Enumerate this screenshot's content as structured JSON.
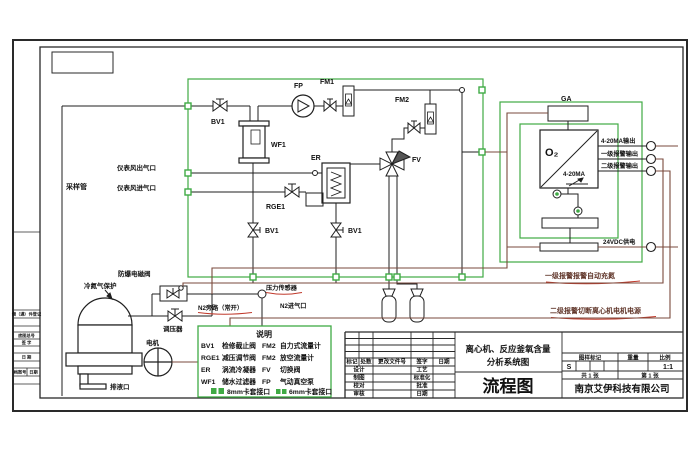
{
  "colors": {
    "green": "#3faa44",
    "brown": "#7a4a3c",
    "red": "#c0392b",
    "line": "#1f1f1f"
  },
  "strip": {
    "borrow": "借（通）件登记",
    "base_no": "底图总号",
    "sign": "签 字",
    "date": "日 期",
    "archive": "档案号",
    "archive_date": "日期"
  },
  "field": {
    "sample_pipe": "采样管",
    "air_out": "仪表风出气口",
    "air_in": "仪表风进气口",
    "n2_protect": "冷氮气保护",
    "solenoid": "防爆电磁阀",
    "regulator": "调压器",
    "motor": "电机",
    "drain": "排液口"
  },
  "process": {
    "bv1": "BV1",
    "wf1": "WF1",
    "fp": "FP",
    "fm1": "FM1",
    "fm2": "FM2",
    "er": "ER",
    "rge1": "RGE1",
    "fv": "FV",
    "pressure_sensor": "压力传感器",
    "n2_bypass": "N2旁路（常开）",
    "n2_inlet": "N2进气口"
  },
  "analyzer": {
    "ga": "GA",
    "o2": "O₂",
    "o2_signal": "4-20MA",
    "out_420ma": "4-20MA输出",
    "alarm1_out": "一级报警输出",
    "alarm2_out": "二级报警输出",
    "power": "24VDC供电",
    "alarm1_action": "一级报警报警自动充氮",
    "alarm2_action": "二级报警切断离心机电机电源"
  },
  "legend": {
    "title": "说明",
    "entries": [
      {
        "code": "BV1",
        "desc": "检修截止阀"
      },
      {
        "code": "FM2",
        "desc": "自力式流量计"
      },
      {
        "code": "RGE1",
        "desc": "减压调节阀"
      },
      {
        "code": "FM2",
        "desc": "放空流量计"
      },
      {
        "code": "ER",
        "desc": "涡流冷凝器"
      },
      {
        "code": "FV",
        "desc": "切换阀"
      },
      {
        "code": "WF1",
        "desc": "储水过滤器"
      },
      {
        "code": "FP",
        "desc": "气动真空泵"
      }
    ],
    "fit8": "8mm卡套接口",
    "fit6": "6mm卡套接口"
  },
  "titleblock": {
    "product1": "离心机、反应釜氧含量",
    "product2": "分析系统图",
    "name": "流程图",
    "company": "南京艾伊科技有限公司",
    "rev": [
      "标记",
      "处数",
      "更改文件号",
      "签字",
      "日期"
    ],
    "left_rows": [
      "设计",
      "制图",
      "校对",
      "审核"
    ],
    "right_rows": [
      "工艺",
      "标准化",
      "批准",
      "日期"
    ],
    "mark": "图样标记",
    "weight": "重量",
    "scale_label": "比例",
    "mark_value": "S",
    "scale_value": "1:1",
    "total": "共 1 张",
    "sheet": "第 1 张"
  }
}
